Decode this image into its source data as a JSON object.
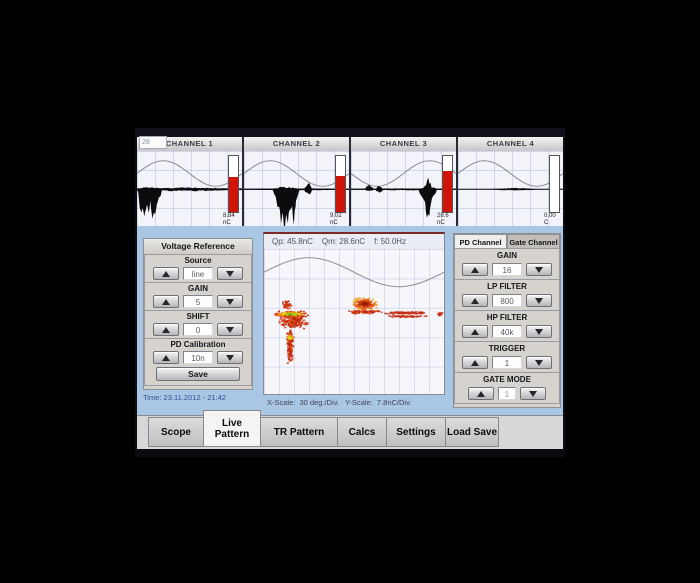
{
  "frame_counter": "28",
  "channels": [
    {
      "label": "CHANNEL 1",
      "value": "8.84",
      "unit": "nC",
      "bar_fill": 63,
      "sine_invert": false,
      "baseline_th": 2.4,
      "blobs": [
        {
          "x0": 0,
          "x1": 24,
          "depth": 34,
          "up": 4
        },
        {
          "x0": 1,
          "x1": 10,
          "depth": 52,
          "up": 3
        },
        {
          "x0": 12,
          "x1": 20,
          "depth": 44,
          "up": 2
        },
        {
          "x0": 0,
          "x1": 100,
          "depth": 3,
          "up": 2.5
        },
        {
          "x0": 55,
          "x1": 75,
          "depth": 4,
          "up": 1
        }
      ]
    },
    {
      "label": "CHANNEL 2",
      "value": "9.02",
      "unit": "nC",
      "bar_fill": 64,
      "sine_invert": false,
      "baseline_th": 1.8,
      "blobs": [
        {
          "x0": 27,
          "x1": 53,
          "depth": 40,
          "up": 4
        },
        {
          "x0": 32,
          "x1": 45,
          "depth": 60,
          "up": 2
        },
        {
          "x0": 45,
          "x1": 50,
          "depth": 50,
          "up": 2
        },
        {
          "x0": 57,
          "x1": 65,
          "depth": 9,
          "up": 9
        },
        {
          "x0": 0,
          "x1": 100,
          "depth": 1.6,
          "up": 1.4
        }
      ]
    },
    {
      "label": "CHANNEL 3",
      "value": "28.6",
      "unit": "nC",
      "bar_fill": 74,
      "sine_invert": true,
      "baseline_th": 1.8,
      "blobs": [
        {
          "x0": 13,
          "x1": 22,
          "depth": 4,
          "up": 6
        },
        {
          "x0": 23,
          "x1": 31,
          "depth": 5,
          "up": 5
        },
        {
          "x0": 64,
          "x1": 82,
          "depth": 26,
          "up": 6
        },
        {
          "x0": 70,
          "x1": 77,
          "depth": 50,
          "up": 16
        },
        {
          "x0": 0,
          "x1": 100,
          "depth": 1.6,
          "up": 1.4
        }
      ]
    },
    {
      "label": "CHANNEL 4",
      "value": "0.00",
      "unit": "C",
      "bar_fill": 0,
      "sine_invert": false,
      "baseline_th": 1.4,
      "blobs": [
        {
          "x0": 30,
          "x1": 78,
          "depth": 2,
          "up": 2
        }
      ]
    }
  ],
  "voltage_reference": {
    "title": "Voltage Reference",
    "groups": [
      {
        "label": "Source",
        "value": "line"
      },
      {
        "label": "GAIN",
        "value": "5"
      },
      {
        "label": "SHIFT",
        "value": "0"
      },
      {
        "label": "PD Calibration",
        "value": "10n"
      }
    ],
    "save_label": "Save"
  },
  "time_label": "Time: 23.11.2012 - 21:42",
  "pattern": {
    "header": {
      "qp": "Qp: 45.8nC",
      "qm": "Qm: 28.6nC",
      "f": "f: 50.0Hz"
    },
    "scale_label": "X-Scale:  30 deg./Div.   Y-Scale:  7.8nC/Div.",
    "sine": {
      "mid": 16,
      "amp": 10
    },
    "dot": {
      "w": 1.15,
      "h": 1.0
    },
    "palettes": {
      "heat": [
        "#46a818",
        "#a8c810",
        "#f0d818",
        "#f09018",
        "#e04810",
        "#c03008"
      ],
      "dome": [
        "#982000",
        "#c83808",
        "#e86818",
        "#f0a830"
      ],
      "reds": [
        "#d03010",
        "#c02808",
        "#e05828",
        "#b82000"
      ],
      "sparse": [
        "#c83018",
        "#d84828",
        "#b82810"
      ]
    },
    "clusters": [
      {
        "name": "main-band",
        "cx": 15,
        "cy": 45,
        "rx": 10,
        "ry": 2.2,
        "n": 220,
        "palette": "heat",
        "ordered": true
      },
      {
        "name": "main-spread",
        "cx": 16,
        "cy": 50,
        "rx": 8.5,
        "ry": 5,
        "n": 170,
        "palette": "reds"
      },
      {
        "name": "upper-puff",
        "cx": 13,
        "cy": 38.5,
        "rx": 2.6,
        "ry": 3,
        "n": 50,
        "palette": "reds"
      },
      {
        "name": "tail",
        "cx": 14.5,
        "cy": 67,
        "rx": 2,
        "ry": 13,
        "n": 120,
        "palette": "reds"
      },
      {
        "name": "tail-hotspot",
        "cx": 14.5,
        "cy": 61,
        "rx": 2,
        "ry": 2.5,
        "n": 50,
        "palette": "heat",
        "ordered": true
      },
      {
        "name": "dome",
        "cx": 56,
        "cy": 38,
        "rx": 7.5,
        "ry": 4.5,
        "n": 200,
        "palette": "dome",
        "ordered": true
      },
      {
        "name": "dome-base",
        "cx": 56.5,
        "cy": 43.5,
        "rx": 9.5,
        "ry": 1.4,
        "n": 90,
        "palette": "reds"
      },
      {
        "name": "streak-1",
        "cx": 79,
        "cy": 44,
        "rx": 12,
        "ry": 0.9,
        "n": 120,
        "palette": "sparse"
      },
      {
        "name": "streak-2",
        "cx": 80,
        "cy": 46.5,
        "rx": 11,
        "ry": 0.7,
        "n": 55,
        "palette": "sparse"
      },
      {
        "name": "edge-dots",
        "cx": 98,
        "cy": 45,
        "rx": 2,
        "ry": 1.6,
        "n": 18,
        "palette": "sparse"
      }
    ]
  },
  "channel_settings": {
    "tabs": [
      {
        "label": "PD Channel",
        "active": true
      },
      {
        "label": "Gate Channel",
        "active": false
      }
    ],
    "groups": [
      {
        "label": "GAIN",
        "value": "16"
      },
      {
        "label": "LP FILTER",
        "value": "800"
      },
      {
        "label": "HP FILTER",
        "value": "40k"
      },
      {
        "label": "TRIGGER",
        "value": "1"
      },
      {
        "label": "GATE MODE",
        "value": "1",
        "small": true
      }
    ]
  },
  "bottom_tabs": [
    {
      "label": "Scope",
      "active": false,
      "cls": "t-scope"
    },
    {
      "label": "Live Pattern",
      "active": true,
      "cls": "t-live"
    },
    {
      "label": "TR Pattern",
      "active": false,
      "cls": "t-tr"
    },
    {
      "label": "Calcs",
      "active": false,
      "cls": "t-calcs"
    },
    {
      "label": "Settings",
      "active": false,
      "cls": "t-settings"
    },
    {
      "label": "Load Save",
      "active": false,
      "cls": "t-load"
    }
  ],
  "colors": {
    "accent_bar": "#d01408",
    "background_blue": "#a9c6e4",
    "pattern_line_red": "#7a2a2a"
  }
}
